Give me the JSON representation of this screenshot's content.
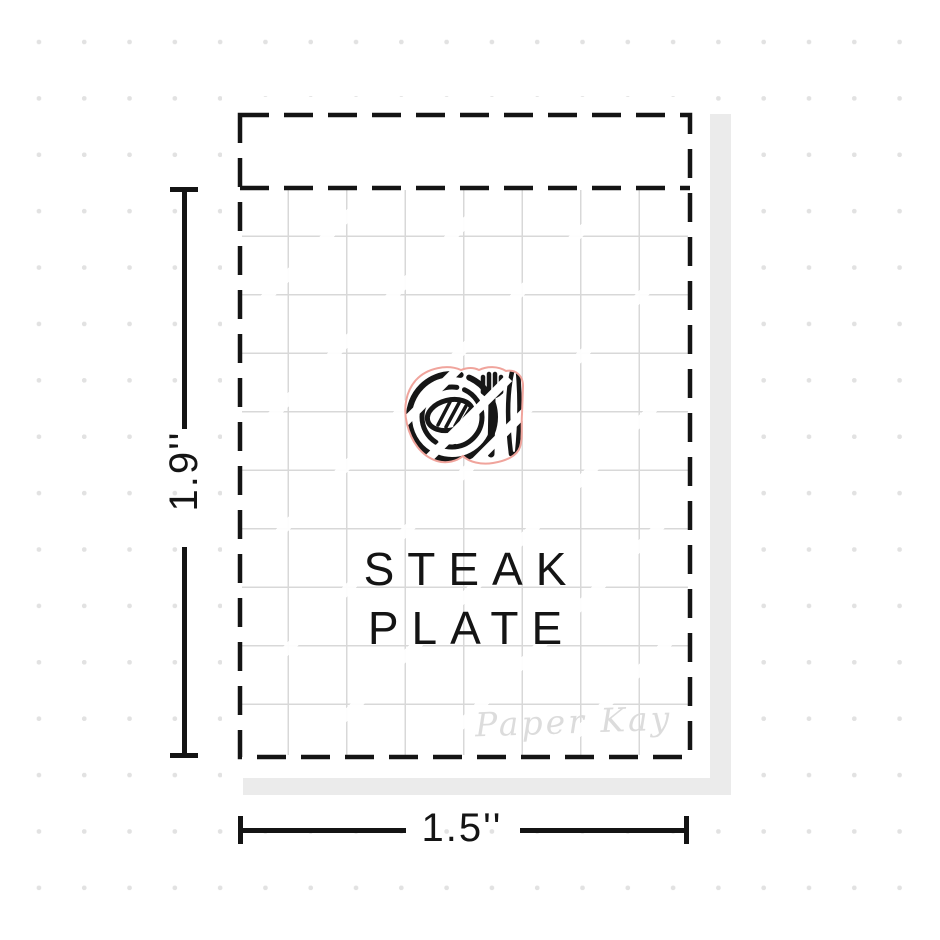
{
  "sticker_sheet": {
    "title_line1": "STEAK",
    "title_line2": "PLATE",
    "watermark": "Paper Kay",
    "icon": "steak-plate-icon"
  },
  "dimensions": {
    "height_label": "1.9''",
    "width_label": "1.5''"
  },
  "colors": {
    "ink": "#141414",
    "cut_line": "#f0a49c",
    "grid_line": "#d8d8d8",
    "dot": "#e2e2e2",
    "shadow": "#ebebeb",
    "watermark_text": "#dcdcdc",
    "paper": "#ffffff"
  }
}
